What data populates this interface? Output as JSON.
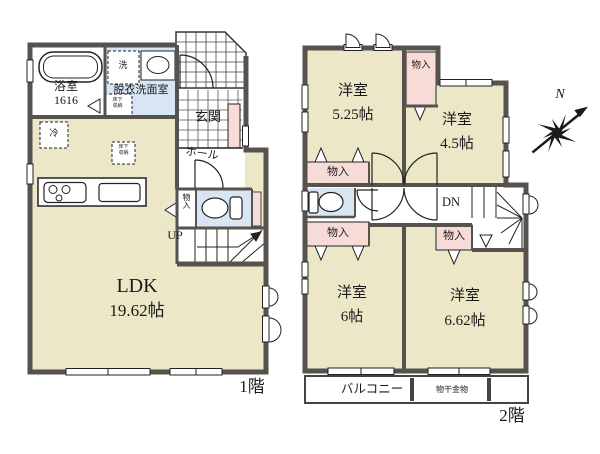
{
  "colors": {
    "wall": "#56524d",
    "room_beige": "#ebe7c7",
    "water_blue": "#d7e6f2",
    "closet_pink": "#f7dbd7"
  },
  "floor1": {
    "floor_label": "1階",
    "bath_label": "浴室",
    "bath_size": "1616",
    "washroom_label": "脱衣洗面室",
    "washer_label": "洗",
    "fridge_label": "冷",
    "floor_storage_label": "床下収納",
    "entrance_label": "玄関",
    "hall_label": "ホール",
    "closet_label": "物入",
    "up_label": "UP",
    "ldk_label": "LDK",
    "ldk_size": "19.62帖"
  },
  "floor2": {
    "floor_label": "2階",
    "room_525_label": "洋室",
    "room_525_size": "5.25帖",
    "room_45_label": "洋室",
    "room_45_size": "4.5帖",
    "room_6_label": "洋室",
    "room_6_size": "6帖",
    "room_662_label": "洋室",
    "room_662_size": "6.62帖",
    "closet_top_label": "物入",
    "closet_mid_label": "物入",
    "closet_low_label": "物入",
    "closet_stair_label": "物入",
    "dn_label": "DN",
    "balcony_label": "バルコニー",
    "drying_label": "物干金物"
  },
  "compass": {
    "north_label": "N"
  }
}
